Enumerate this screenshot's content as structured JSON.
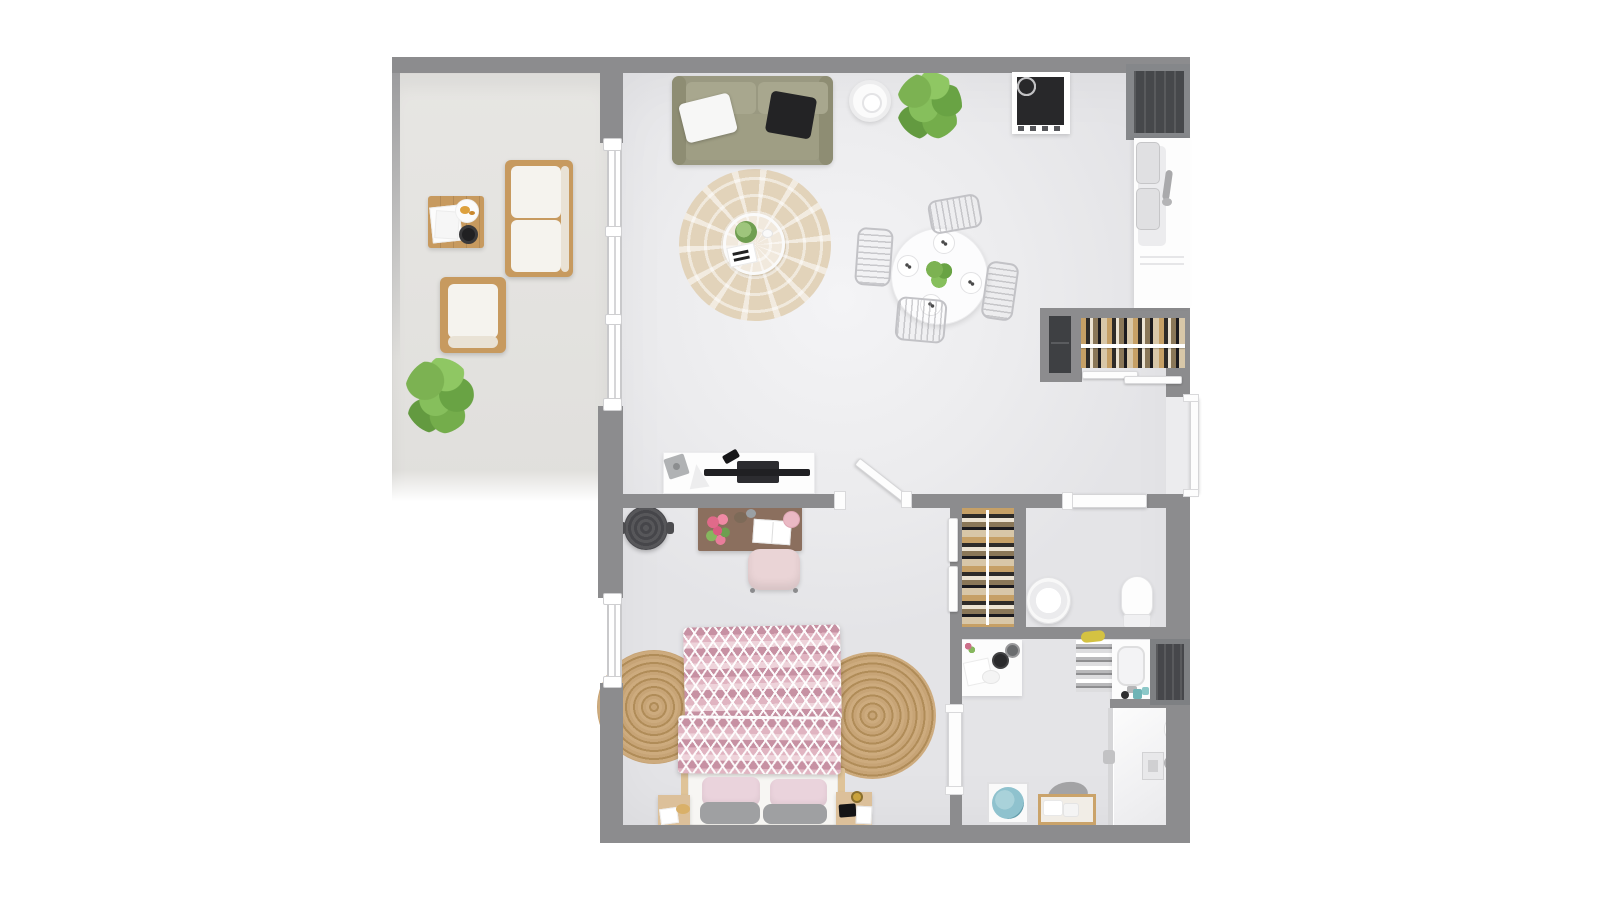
{
  "scene": {
    "type": "apartment-floor-plan",
    "view": "top-down 3D render",
    "background": "#ffffff"
  },
  "palette": {
    "wall": "#8c8c8e",
    "floor": "#ededef",
    "balcony_floor": "#e4e3e0",
    "wood": "#c79a5f",
    "sofa_olive": "#9a9981",
    "rug_beige": "#e2d3ba",
    "jute": "#c7a476",
    "duvet_pink": "#c791a3",
    "desk_wood": "#8b6f5e",
    "chair_pink": "#ead4d6",
    "plant_green": "#7cb252",
    "towel_blue": "#8fc2ce",
    "appliance_dark": "#28282a"
  },
  "rooms": {
    "balcony": "Balcony",
    "living": "Living room and open kitchen",
    "bedroom": "Bedroom",
    "wc": "WC",
    "bathroom": "Shower room",
    "hall_wardrobe": "Hallway wardrobe",
    "bedroom_wardrobe": "Bedroom wardrobe"
  },
  "labels": {
    "outdoor_sofa": "Outdoor wooden sofa with white cushions",
    "outdoor_chair": "Outdoor wooden armchair",
    "outdoor_table": "Outdoor coffee table with magazines, plate and bowl",
    "balcony_plant": "Potted plant",
    "sofa": "Olive green sofa with white and black pillows",
    "side_table": "Round white side table",
    "plant": "Large potted plant",
    "cooktop": "Four-burner cooktop",
    "tall_unit": "Dark tall kitchen unit",
    "sink_counter": "Kitchen counter with double sink",
    "area_rug": "Round beige rug with white leaf pattern",
    "coffee_table": "Round glass coffee table with plant and notebook",
    "dining_table": "Round white dining table with plant",
    "dining_chair": "Wire dining chair",
    "dining_plate": "Place setting",
    "tv_console": "White TV console with flat screen TV",
    "hall_wardrobe": "Wardrobe with hanging clothes and sliding doors",
    "bedroom_wardrobe": "Wardrobe with hanging clothes",
    "desk": "Wooden desk with flowers and open book",
    "desk_chair": "Pink desk chair",
    "storage_basket": "Dark round basket",
    "bed": "Double bed with pink chevron duvet",
    "pillow": "Pillow",
    "nightstand": "Wooden nightstand",
    "jute_rug": "Round jute rug",
    "wash_bowl": "Round freestanding basin",
    "toilet": "Toilet",
    "vanity_table": "Vanity table with cosmetics",
    "striped_towel": "Striped towel with soap",
    "bathroom_sink": "Washbasin unit",
    "bathroom_cabinet": "Dark bathroom cabinet",
    "shower": "Walk-in shower with glass panel",
    "towel_shelf": "Wooden towel shelf",
    "towel_basket": "Basket with blue towel",
    "entry_door": "Entrance door",
    "bedroom_door": "Open bedroom door",
    "wc_door": "WC door",
    "bathroom_door": "Shower room door",
    "balcony_door": "Sliding glass balcony door",
    "bedroom_window": "Bedroom window",
    "wall": "Wall"
  }
}
